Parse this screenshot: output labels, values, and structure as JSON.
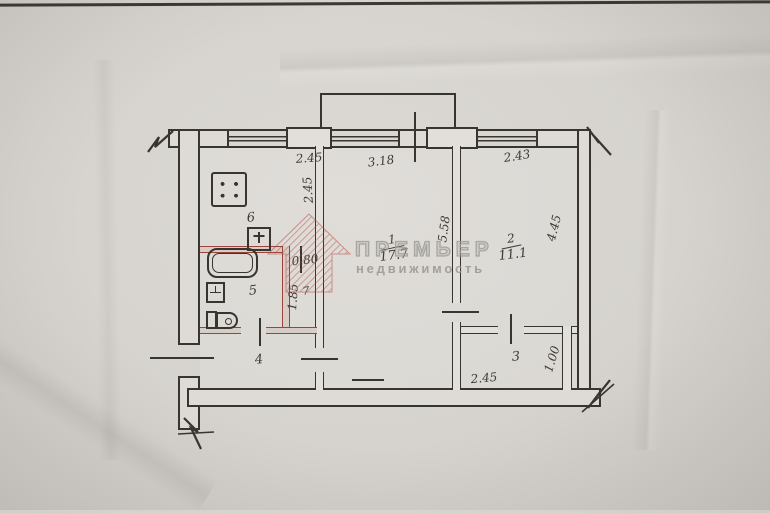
{
  "document": {
    "type": "scanned apartment floor plan"
  },
  "watermark": {
    "brand": "ПРЕМЬЕР",
    "tagline": "недвижимость"
  },
  "rooms": {
    "r1": {
      "label": "1",
      "area": "17.7"
    },
    "r2": {
      "label": "2",
      "area": "11.1"
    },
    "r3": {
      "label": "3"
    },
    "r4": {
      "label": "4"
    },
    "r5": {
      "label": "5"
    },
    "r6": {
      "label": "6"
    },
    "r7": {
      "label": "7"
    }
  },
  "dimensions": {
    "kitchen_width": "2.45",
    "room1_width": "3.18",
    "room2_width": "2.43",
    "kitchen_depth": "2.45",
    "room1_depth": "5.58",
    "room2_depth": "4.45",
    "wc_width": "0.80",
    "wc_depth": "1.85",
    "room3_width": "2.45",
    "room3_depth": "1.00"
  },
  "colors": {
    "ink": "#37352f",
    "paper": "#d7d4cf",
    "wet_wall_red": "#9a453c",
    "watermark_red": "#b0443a",
    "watermark_gray": "#a3a09b"
  }
}
